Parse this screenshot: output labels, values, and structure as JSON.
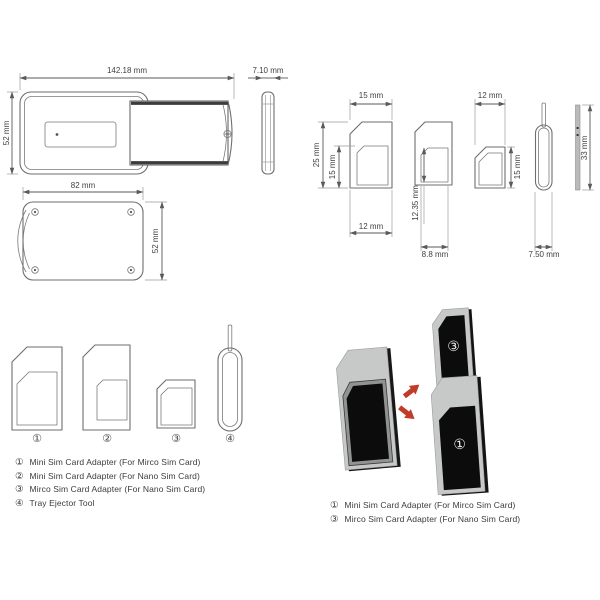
{
  "holder": {
    "front_width_label": "142.18 mm",
    "front_height_label": "52 mm",
    "side_width_label": "7.10 mm",
    "back_width_label": "82 mm",
    "back_height_label": "52 mm"
  },
  "dims": {
    "mini_adapter": {
      "top": "15 mm",
      "left": "25 mm",
      "inner": "15 mm",
      "bottom": "12 mm"
    },
    "nano_cutout": {
      "height": "12.35 mm",
      "width": "8.8 mm"
    },
    "micro_adapter": {
      "top": "12 mm",
      "right": "15 mm"
    },
    "ejector": {
      "width": "7.50 mm",
      "length": "33 mm"
    }
  },
  "items_legend": {
    "markers": [
      "①",
      "②",
      "③",
      "④"
    ],
    "entries": [
      {
        "num": "①",
        "label": "Mini Sim Card Adapter (For Mirco Sim Card)"
      },
      {
        "num": "②",
        "label": "Mini Sim Card Adapter (For Nano Sim Card)"
      },
      {
        "num": "③",
        "label": "Mirco Sim Card Adapter (For Nano Sim Card)"
      },
      {
        "num": "④",
        "label": "Tray Ejector Tool"
      }
    ]
  },
  "usage": {
    "card_small_marker": "③",
    "card_large_marker": "①",
    "entries": [
      {
        "num": "①",
        "label": "Mini Sim Card Adapter (For Mirco Sim Card)"
      },
      {
        "num": "③",
        "label": "Mirco Sim Card Adapter (For Nano Sim Card)"
      }
    ]
  },
  "colors": {
    "line": "#6e6e6e",
    "dim": "#5a5a5a",
    "text": "#3f3f3f",
    "arrow_red": "#c23a28",
    "adapter_gray": "#c7c9c8",
    "card_black": "#0c0c0c"
  }
}
